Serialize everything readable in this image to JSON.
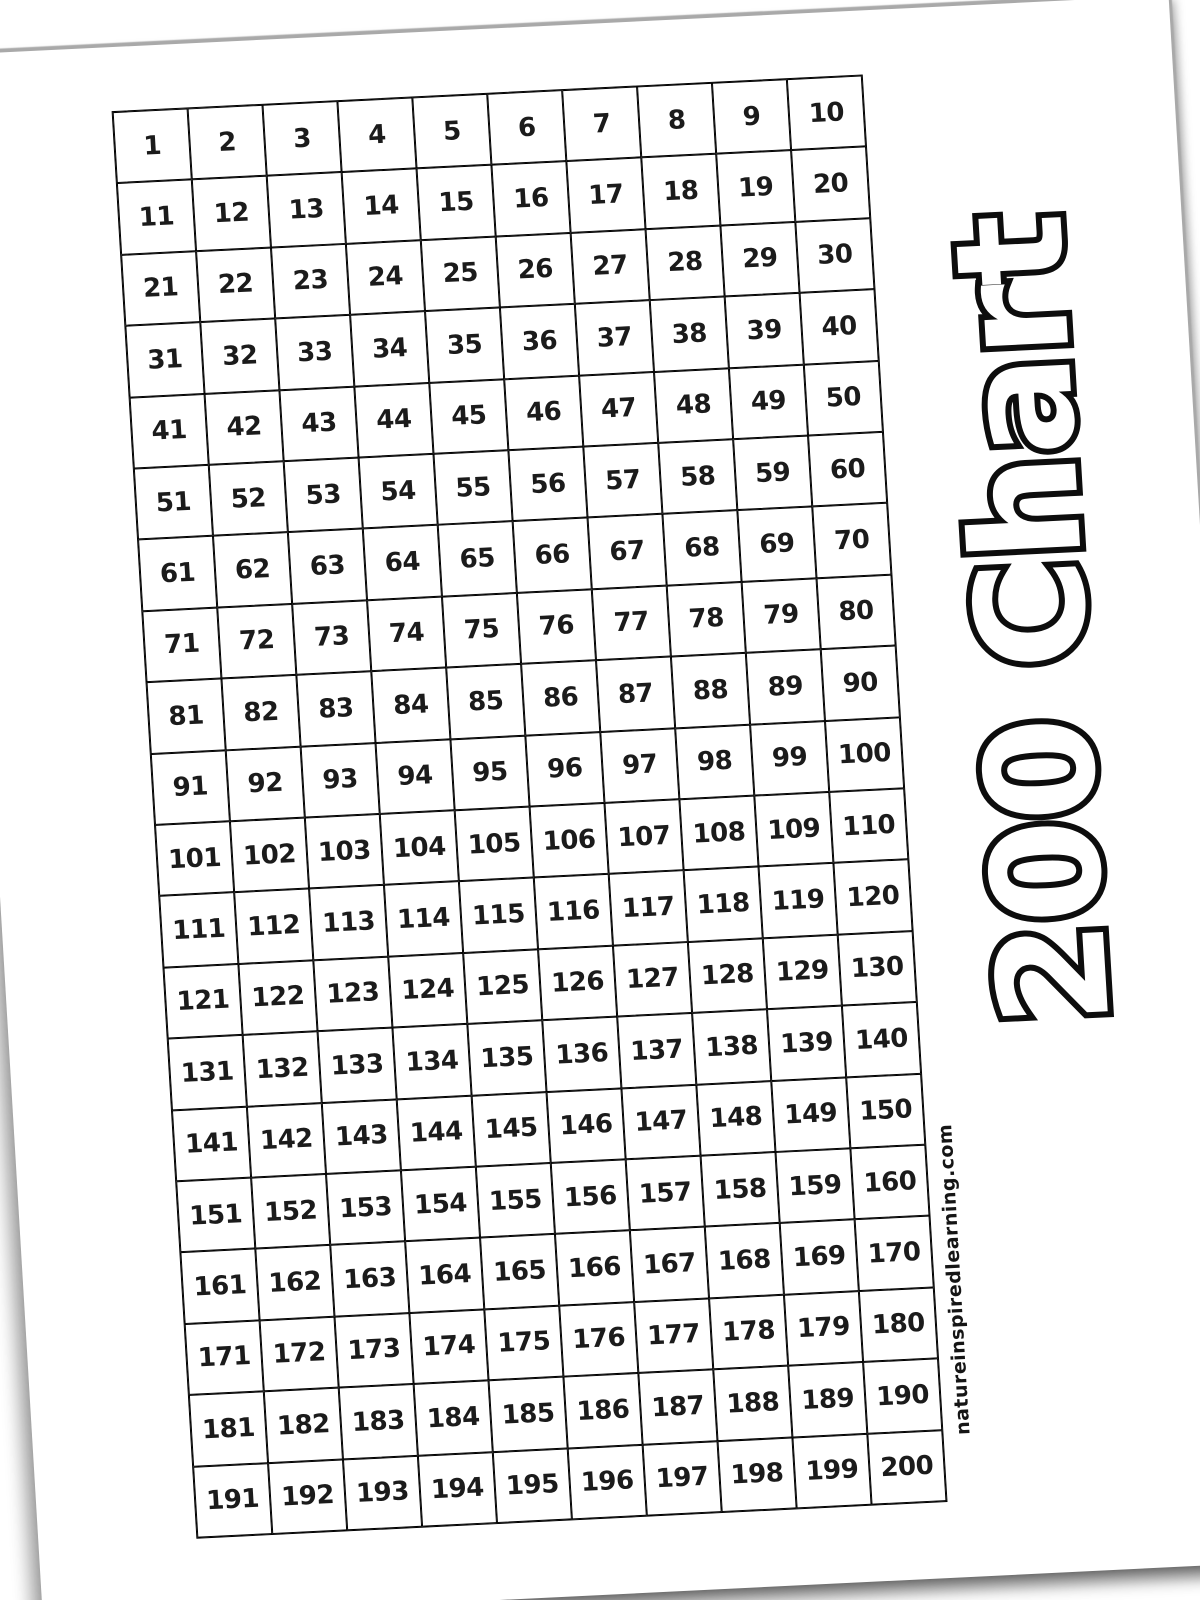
{
  "title": {
    "text": "200 Chart"
  },
  "watermark": {
    "text": "natureinspiredlearning.com"
  },
  "colors": {
    "background": "#ffffff",
    "paper": "#ffffff",
    "grid_border": "#000000",
    "number_color": "#1b1b1b",
    "title_fill": "#ffffff",
    "title_outline": "#0d0d0d",
    "edge_shadow": "#a9a9a9"
  },
  "grid": {
    "rows": 20,
    "columns": 10,
    "first_number": 1,
    "last_number": 200,
    "numbers": [
      1,
      2,
      3,
      4,
      5,
      6,
      7,
      8,
      9,
      10,
      11,
      12,
      13,
      14,
      15,
      16,
      17,
      18,
      19,
      20,
      21,
      22,
      23,
      24,
      25,
      26,
      27,
      28,
      29,
      30,
      31,
      32,
      33,
      34,
      35,
      36,
      37,
      38,
      39,
      40,
      41,
      42,
      43,
      44,
      45,
      46,
      47,
      48,
      49,
      50,
      51,
      52,
      53,
      54,
      55,
      56,
      57,
      58,
      59,
      60,
      61,
      62,
      63,
      64,
      65,
      66,
      67,
      68,
      69,
      70,
      71,
      72,
      73,
      74,
      75,
      76,
      77,
      78,
      79,
      80,
      81,
      82,
      83,
      84,
      85,
      86,
      87,
      88,
      89,
      90,
      91,
      92,
      93,
      94,
      95,
      96,
      97,
      98,
      99,
      100,
      101,
      102,
      103,
      104,
      105,
      106,
      107,
      108,
      109,
      110,
      111,
      112,
      113,
      114,
      115,
      116,
      117,
      118,
      119,
      120,
      121,
      122,
      123,
      124,
      125,
      126,
      127,
      128,
      129,
      130,
      131,
      132,
      133,
      134,
      135,
      136,
      137,
      138,
      139,
      140,
      141,
      142,
      143,
      144,
      145,
      146,
      147,
      148,
      149,
      150,
      151,
      152,
      153,
      154,
      155,
      156,
      157,
      158,
      159,
      160,
      161,
      162,
      163,
      164,
      165,
      166,
      167,
      168,
      169,
      170,
      171,
      172,
      173,
      174,
      175,
      176,
      177,
      178,
      179,
      180,
      181,
      182,
      183,
      184,
      185,
      186,
      187,
      188,
      189,
      190,
      191,
      192,
      193,
      194,
      195,
      196,
      197,
      198,
      199,
      200
    ]
  }
}
